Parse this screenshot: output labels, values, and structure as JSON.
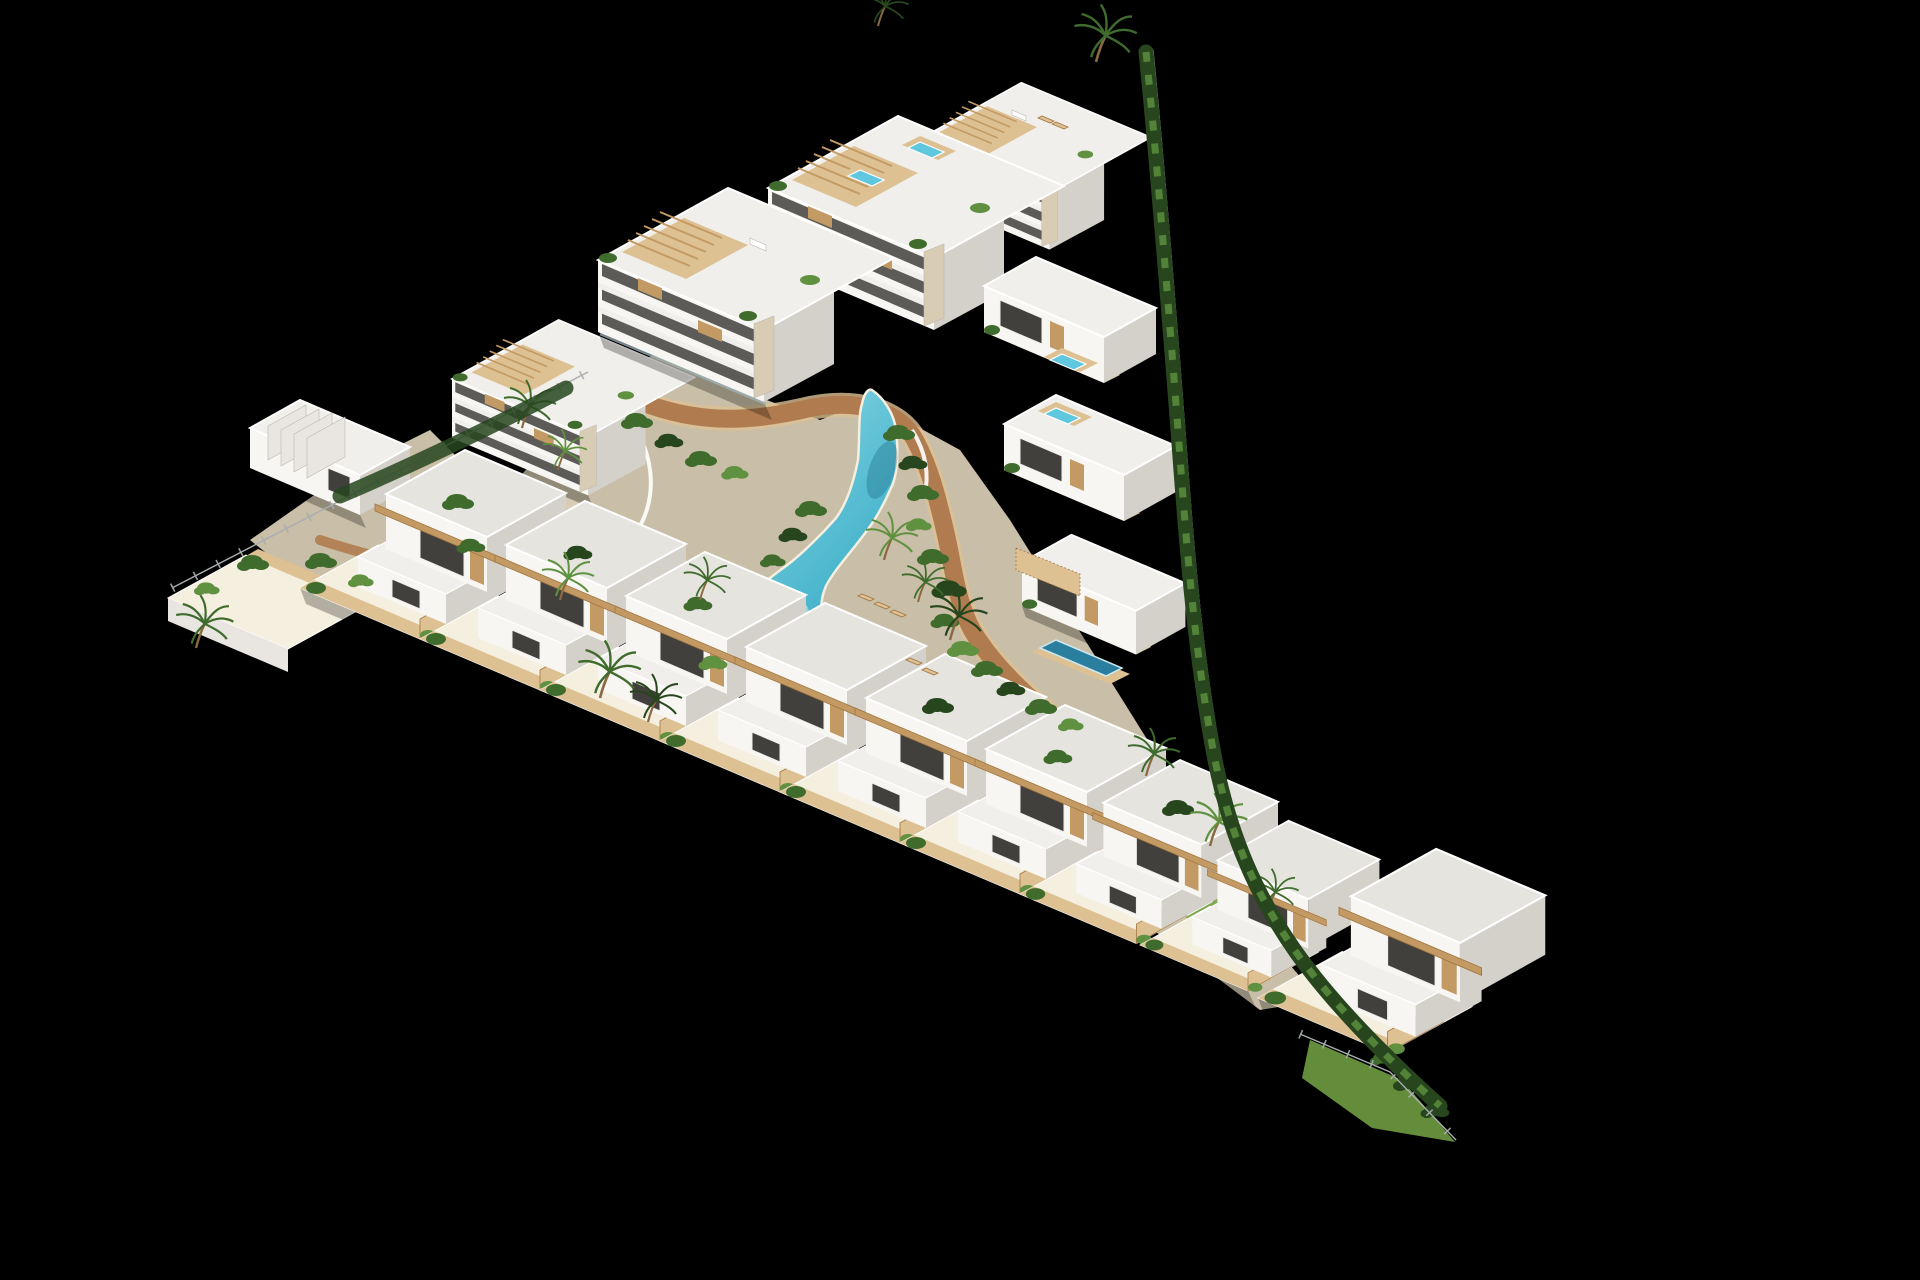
{
  "scene": {
    "type": "aerial-3d-architectural-render",
    "subject": "triangular coastal residential development with lagoon pool",
    "background": "black",
    "features": {
      "townhouse_row_units": 9,
      "apartment_blocks": 3,
      "right_wing_blocks": 3,
      "rooftop_jacuzzis": 4,
      "lagoon_pool": 1,
      "wooden_bridge": 1,
      "private_pool": 1,
      "palm_trees": 15,
      "perimeter_fence": 1,
      "hedge_wall": 1,
      "sun_loungers": 5
    }
  },
  "palette": {
    "bg": "#000000",
    "wallBright": "#ffffff",
    "wallLight": "#f8f6f2",
    "wallMid": "#e9e6e1",
    "wallShadow": "#d4d1ca",
    "wallDark": "#bab6ae",
    "roof": "#e6e4df",
    "roofBright": "#f1efeb",
    "windowDark": "#41403d",
    "glass": "#9fb3ba",
    "wood": "#c49a64",
    "woodLight": "#ddc193",
    "woodDark": "#a3763f",
    "stone": "#d8cdb4",
    "sand": "#ecdfc4",
    "sandLight": "#f5efdf",
    "pathBrown": "#b07c4f",
    "greenDark": "#27461e",
    "green": "#3f6b2c",
    "greenLight": "#5f9140",
    "lawn": "#74a644",
    "pool": "#3fb0c9",
    "poolDeep": "#1f8cab",
    "poolLight": "#8ed9e6",
    "jacuzzi": "#5fc8de",
    "privatePool": "#2a7f9e",
    "fence": "#a9adb0",
    "trunk": "#8a6a42",
    "shadow": "rgba(0,0,0,0.45)"
  }
}
